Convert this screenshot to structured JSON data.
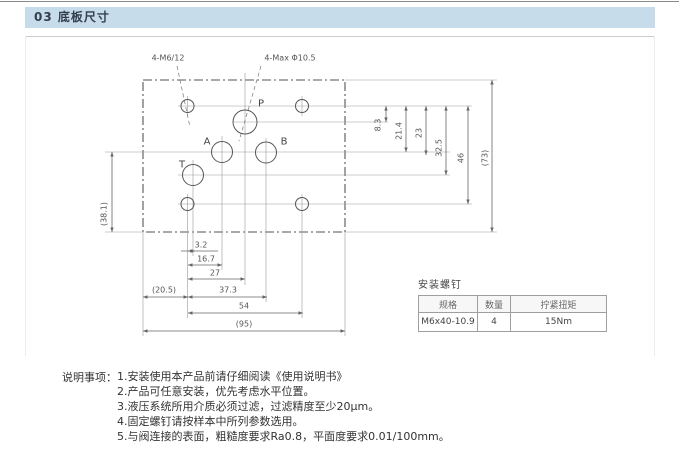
{
  "page": {
    "title_bar": "03 底板尺寸"
  },
  "drawing": {
    "callout_threads": "4-M6/12",
    "callout_ports": "4-Max Φ10.5",
    "port_p": "P",
    "port_a": "A",
    "port_b": "B",
    "port_t": "T",
    "dim_3_2": "3.2",
    "dim_16_7": "16.7",
    "dim_27": "27",
    "dim_20_5": "(20.5)",
    "dim_37_3": "37.3",
    "dim_54": "54",
    "dim_95": "(95)",
    "dim_8_3": "8.3",
    "dim_21_4": "21.4",
    "dim_23": "23",
    "dim_32_5": "32.5",
    "dim_46": "46",
    "dim_73": "(73)",
    "dim_38_1": "(38.1)"
  },
  "screw_table": {
    "title": "安装螺钉",
    "headers": [
      "规格",
      "数量",
      "拧紧扭矩"
    ],
    "row": [
      "M6x40-10.9",
      "4",
      "15Nm"
    ]
  },
  "notes": {
    "label": "说明事项：",
    "items": [
      "1.安装使用本产品前请仔细阅读《使用说明书》",
      "2.产品可任意安装，优先考虑水平位置。",
      "3.液压系统所用介质必须过滤，过滤精度至少20μm。",
      "4.固定螺钉请按样本中所列参数选用。",
      "5.与阀连接的表面，粗糙度要求Ra0.8，平面度要求0.01/100mm。"
    ]
  }
}
